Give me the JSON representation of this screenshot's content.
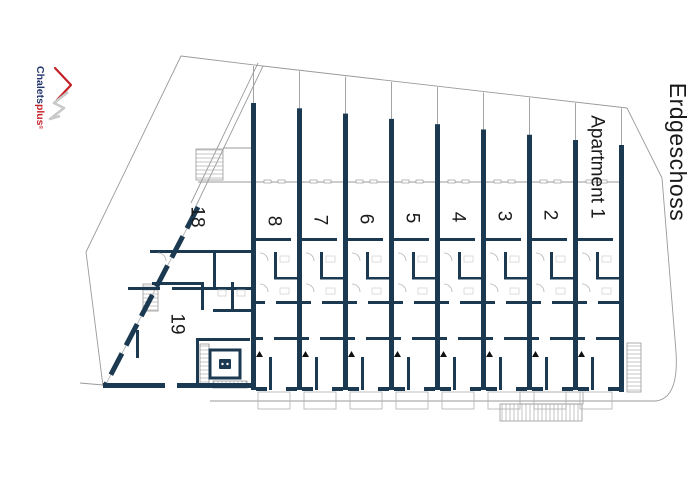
{
  "header": {
    "floor_label": "Erdgeschoss"
  },
  "logo": {
    "name": "ChaletsPlus",
    "part1": "Chalets",
    "part2": "plus",
    "registered": "®",
    "color_text": "#23356b",
    "color_accent": "#c42127",
    "color_mountain": "#c9c9c9"
  },
  "plan": {
    "type": "architectural-floor-plan",
    "wall_color": "#1b3a52",
    "outline_color": "#9a9a9a",
    "hatch_color": "#b5b5b5",
    "text_color": "#1a1a1a",
    "units": [
      {
        "label": "8",
        "x": 251
      },
      {
        "label": "7",
        "x": 297
      },
      {
        "label": "6",
        "x": 343
      },
      {
        "label": "5",
        "x": 389
      },
      {
        "label": "4",
        "x": 435
      },
      {
        "label": "3",
        "x": 481
      },
      {
        "label": "2",
        "x": 527
      },
      {
        "label": "Apartment 1",
        "x": 573,
        "featured": true
      }
    ],
    "side_units": [
      {
        "label": "18",
        "cx": 197,
        "cy": 217
      },
      {
        "label": "19",
        "cx": 177,
        "cy": 324
      }
    ]
  }
}
